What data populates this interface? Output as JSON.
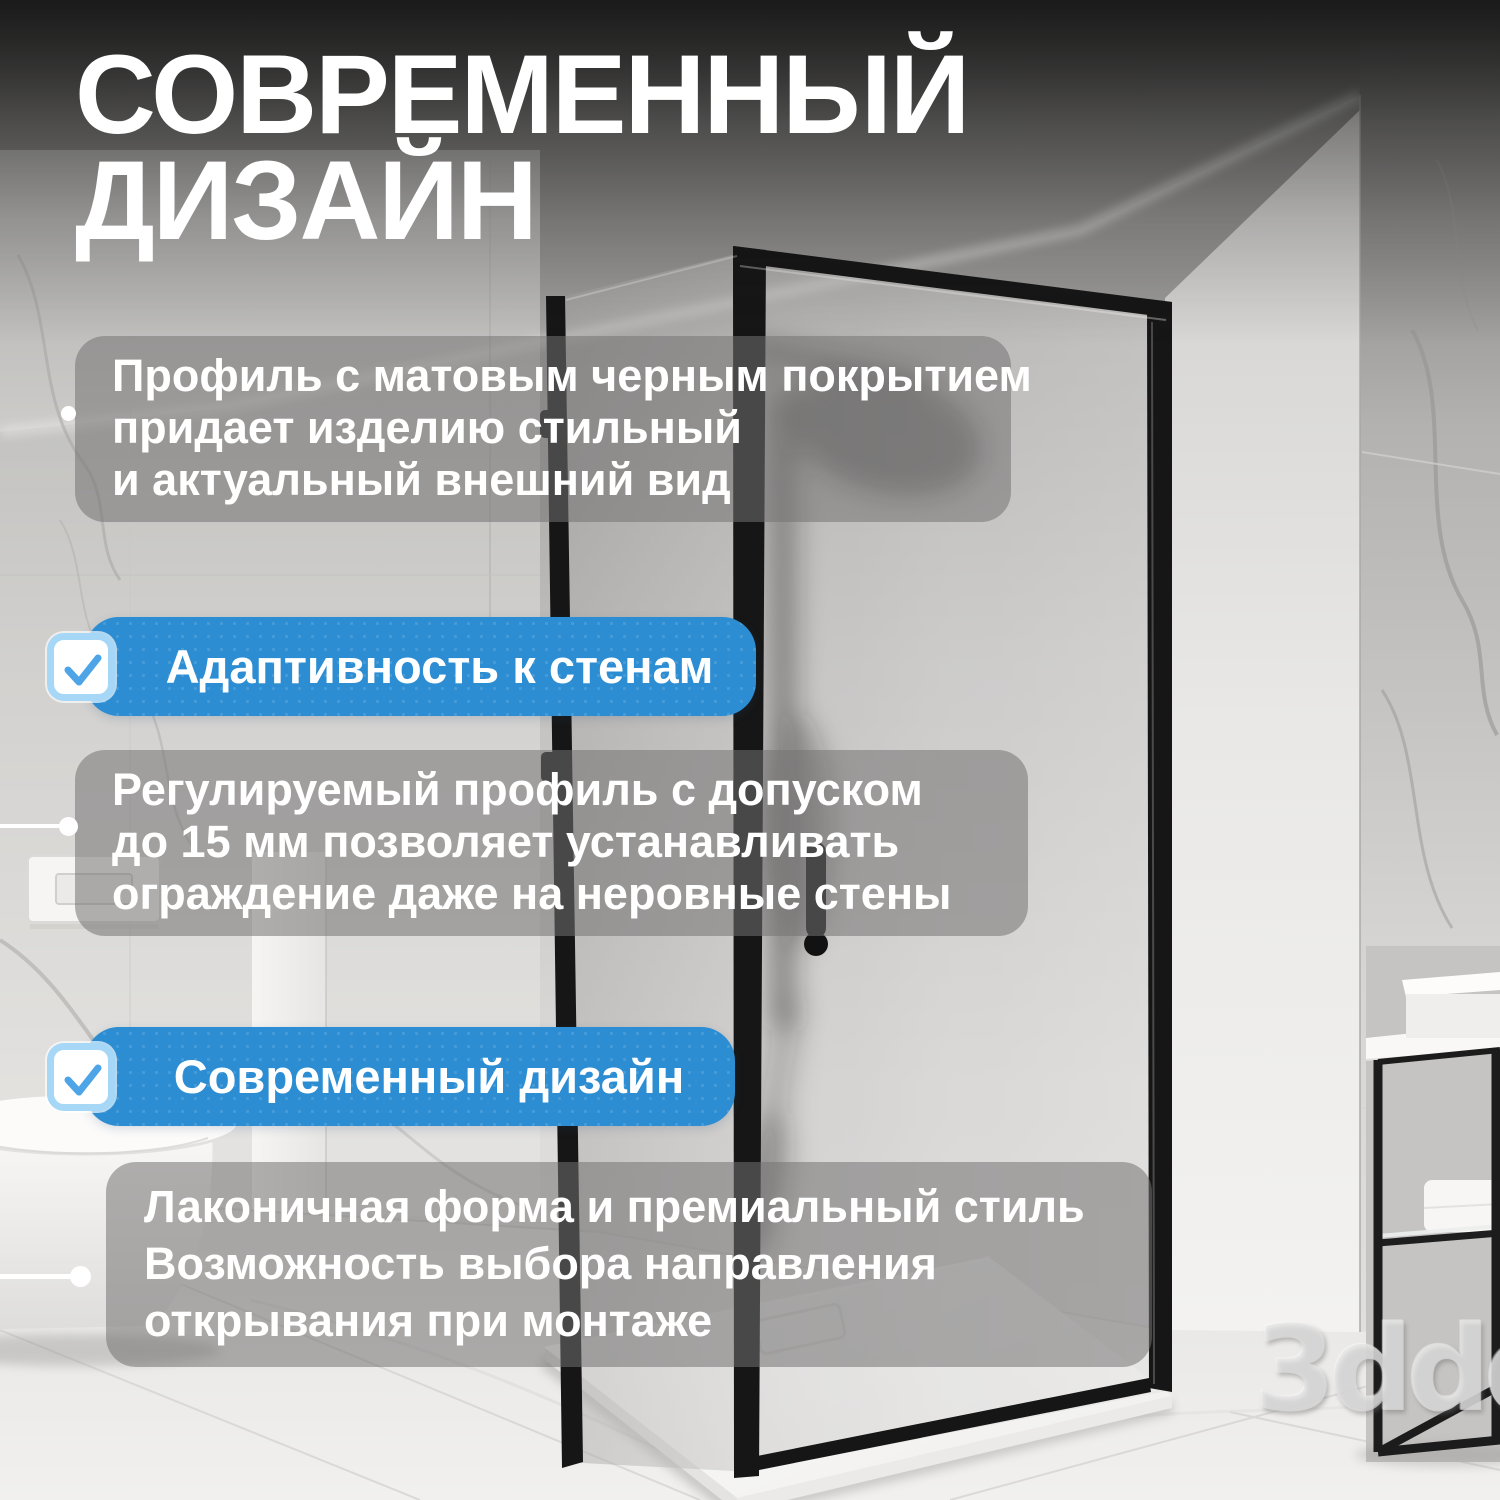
{
  "title": {
    "line1": "СОВРЕМЕННЫЙ",
    "line2": "ДИЗАЙН"
  },
  "card1": {
    "lines": [
      "Профиль с матовым черным покрытием",
      "придает изделию стильный",
      "и актуальный внешний вид"
    ]
  },
  "badge1": {
    "label": "Адаптивность к стенам",
    "icon": "checkmark-icon"
  },
  "card2": {
    "lines": [
      "Регулируемый профиль с допуском",
      "до 15 мм позволяет устанавливать",
      "ограждение даже на неровные стены"
    ]
  },
  "badge2": {
    "label": "Современный дизайн",
    "icon": "checkmark-icon"
  },
  "card3": {
    "lines": [
      "Лаконичная форма и премиальный стиль",
      "Возможность выбора направления",
      "открывания при монтаже"
    ]
  },
  "watermark": {
    "text": "3ddd"
  },
  "colors": {
    "accent_blue": "#2c8dd2",
    "checkbox_border": "#a6d7f7",
    "checkmark_blue": "#4da4e6",
    "card_overlay": "rgba(116,115,114,0.55)",
    "title_text": "#ffffff",
    "frame_black": "#161616"
  }
}
